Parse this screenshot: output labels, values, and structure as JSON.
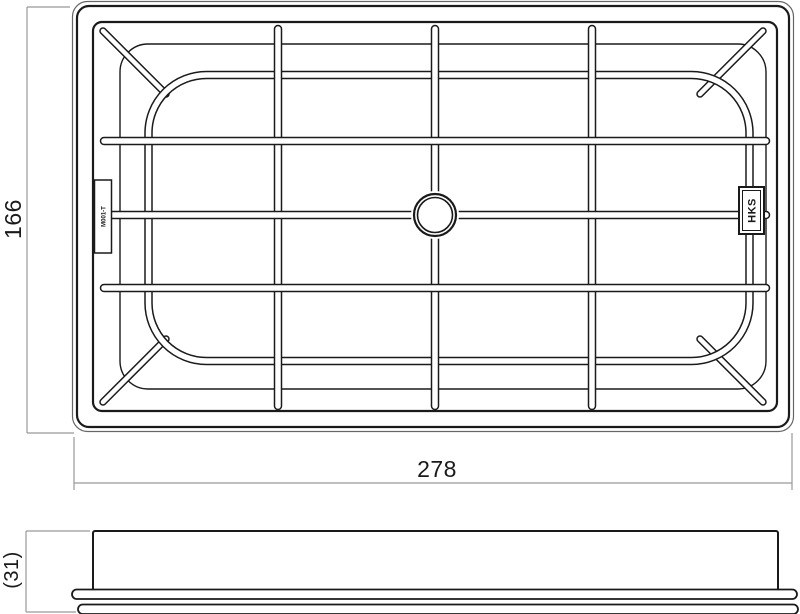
{
  "drawing": {
    "dimensions": {
      "height": "166",
      "width": "278",
      "thickness": "(31)"
    },
    "labels": {
      "logo": "HKS",
      "part_code": "M001-T"
    },
    "colors": {
      "line": "#1a1a1a",
      "outer_line": "#666666",
      "dim_line": "#999999",
      "background": "#ffffff"
    }
  }
}
